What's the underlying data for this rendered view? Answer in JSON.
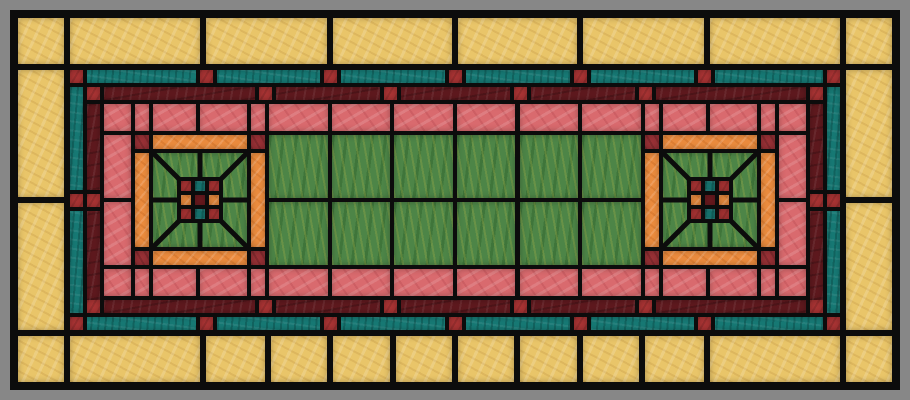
{
  "artwork": {
    "kind": "stained-glass-window-panel",
    "style": "prairie-arts-and-crafts",
    "medallion_count": 2
  },
  "palette": {
    "gray": "#878787",
    "lead": "#0c0c0c",
    "yellow": "#e9c569",
    "teal": "#177a75",
    "maroon": "#5f191e",
    "red": "#ab3434",
    "pink": "#d96a6e",
    "green": "#4d8547",
    "orange": "#ec8c3e",
    "dark_red": "#9a3136",
    "center_maroon": "#6d1a1f"
  },
  "design": {
    "canvas": [
      910,
      400
    ],
    "lead_field": [
      10,
      10,
      890,
      380
    ],
    "layers": [
      {
        "name": "yellow-border-pane",
        "color": "c-yellow",
        "rects": [
          [
            18,
            18,
            46,
            46
          ],
          [
            846,
            18,
            46,
            46
          ],
          [
            18,
            336,
            46,
            46
          ],
          [
            846,
            336,
            46,
            46
          ],
          [
            70,
            18,
            130,
            46
          ],
          [
            206,
            18,
            121,
            46
          ],
          [
            333,
            18,
            119,
            46
          ],
          [
            458,
            18,
            119,
            46
          ],
          [
            583,
            18,
            121,
            46
          ],
          [
            710,
            18,
            130,
            46
          ],
          [
            70,
            336,
            130,
            46
          ],
          [
            206,
            336,
            59,
            46
          ],
          [
            271,
            336,
            56,
            46
          ],
          [
            333,
            336,
            57,
            46
          ],
          [
            396,
            336,
            56,
            46
          ],
          [
            458,
            336,
            56,
            46
          ],
          [
            520,
            336,
            57,
            46
          ],
          [
            583,
            336,
            56,
            46
          ],
          [
            645,
            336,
            59,
            46
          ],
          [
            710,
            336,
            130,
            46
          ],
          [
            18,
            70,
            46,
            127
          ],
          [
            18,
            203,
            46,
            127
          ],
          [
            846,
            70,
            46,
            127
          ],
          [
            846,
            203,
            46,
            127
          ]
        ]
      },
      {
        "name": "teal-band-pane",
        "color": "c-teal",
        "rects": [
          [
            70,
            70,
            770,
            13
          ],
          [
            70,
            317,
            770,
            13
          ],
          [
            70,
            87,
            13,
            226
          ],
          [
            827,
            87,
            13,
            226
          ]
        ]
      },
      {
        "name": "maroon-band-pane",
        "color": "c-maroon",
        "rects": [
          [
            104,
            87,
            702,
            13
          ],
          [
            104,
            300,
            702,
            13
          ],
          [
            87,
            104,
            13,
            196
          ],
          [
            810,
            104,
            13,
            196
          ]
        ]
      },
      {
        "name": "maroon-band-corner-square",
        "color": "c-red",
        "rects": [
          [
            87,
            87,
            13,
            13
          ],
          [
            810,
            87,
            13,
            13
          ],
          [
            87,
            300,
            13,
            13
          ],
          [
            810,
            300,
            13,
            13
          ]
        ]
      },
      {
        "name": "pink-band-corner-pane",
        "color": "c-pink",
        "rects": [
          [
            104,
            104,
            27,
            27
          ],
          [
            779,
            104,
            27,
            27
          ],
          [
            104,
            269,
            27,
            27
          ],
          [
            779,
            269,
            27,
            27
          ]
        ]
      },
      {
        "name": "pink-band-pane",
        "color": "c-pink",
        "rects": [
          [
            135,
            104,
            14,
            27
          ],
          [
            153,
            104,
            43,
            27
          ],
          [
            200,
            104,
            47,
            27
          ],
          [
            251,
            104,
            14,
            27
          ],
          [
            269,
            104,
            59,
            27
          ],
          [
            332,
            104,
            58,
            27
          ],
          [
            394,
            104,
            59,
            27
          ],
          [
            457,
            104,
            58,
            27
          ],
          [
            520,
            104,
            58,
            27
          ],
          [
            582,
            104,
            59,
            27
          ],
          [
            645,
            104,
            14,
            27
          ],
          [
            663,
            104,
            43,
            27
          ],
          [
            710,
            104,
            47,
            27
          ],
          [
            761,
            104,
            14,
            27
          ],
          [
            135,
            269,
            14,
            27
          ],
          [
            153,
            269,
            43,
            27
          ],
          [
            200,
            269,
            47,
            27
          ],
          [
            251,
            269,
            14,
            27
          ],
          [
            269,
            269,
            59,
            27
          ],
          [
            332,
            269,
            58,
            27
          ],
          [
            394,
            269,
            59,
            27
          ],
          [
            457,
            269,
            58,
            27
          ],
          [
            520,
            269,
            58,
            27
          ],
          [
            582,
            269,
            59,
            27
          ],
          [
            645,
            269,
            14,
            27
          ],
          [
            663,
            269,
            43,
            27
          ],
          [
            710,
            269,
            47,
            27
          ],
          [
            761,
            269,
            14,
            27
          ],
          [
            104,
            135,
            27,
            63
          ],
          [
            104,
            202,
            27,
            63
          ],
          [
            779,
            135,
            27,
            63
          ],
          [
            779,
            202,
            27,
            63
          ]
        ]
      },
      {
        "name": "green-field-pane",
        "color": "c-green",
        "rects": [
          [
            269,
            135,
            59,
            63
          ],
          [
            332,
            135,
            58,
            63
          ],
          [
            394,
            135,
            59,
            63
          ],
          [
            457,
            135,
            58,
            63
          ],
          [
            520,
            135,
            58,
            63
          ],
          [
            582,
            135,
            59,
            63
          ],
          [
            269,
            202,
            59,
            63
          ],
          [
            332,
            202,
            58,
            63
          ],
          [
            394,
            202,
            59,
            63
          ],
          [
            457,
            202,
            58,
            63
          ],
          [
            520,
            202,
            58,
            63
          ],
          [
            582,
            202,
            59,
            63
          ]
        ]
      }
    ],
    "accent_squares": {
      "size": 13,
      "teal_band": [
        [
          70,
          70
        ],
        [
          200,
          70
        ],
        [
          324,
          70
        ],
        [
          449,
          70
        ],
        [
          574,
          70
        ],
        [
          698,
          70
        ],
        [
          827,
          70
        ],
        [
          70,
          317
        ],
        [
          200,
          317
        ],
        [
          324,
          317
        ],
        [
          449,
          317
        ],
        [
          574,
          317
        ],
        [
          698,
          317
        ],
        [
          827,
          317
        ],
        [
          70,
          194
        ],
        [
          827,
          194
        ]
      ],
      "maroon_band": [
        [
          259,
          87
        ],
        [
          384,
          87
        ],
        [
          514,
          87
        ],
        [
          639,
          87
        ],
        [
          259,
          300
        ],
        [
          384,
          300
        ],
        [
          514,
          300
        ],
        [
          639,
          300
        ],
        [
          87,
          194
        ],
        [
          810,
          194
        ]
      ]
    },
    "medallions": {
      "origins": [
        [
          135,
          135
        ],
        [
          645,
          135
        ]
      ],
      "size": 130,
      "corner_squares": [
        [
          0,
          0
        ],
        [
          116,
          0
        ],
        [
          0,
          116
        ],
        [
          116,
          116
        ]
      ],
      "corner_size": 14,
      "orange_bars": [
        [
          18,
          0,
          94,
          14
        ],
        [
          18,
          116,
          94,
          14
        ],
        [
          0,
          18,
          14,
          94
        ],
        [
          116,
          18,
          14,
          94
        ]
      ],
      "inner_square": [
        18,
        18,
        94,
        94
      ],
      "lead_lines": [
        [
          0,
          0,
          26,
          26
        ],
        [
          94,
          0,
          68,
          26
        ],
        [
          0,
          94,
          26,
          68
        ],
        [
          94,
          94,
          68,
          68
        ],
        [
          47,
          0,
          47,
          26
        ],
        [
          47,
          94,
          47,
          68
        ],
        [
          0,
          47,
          26,
          47
        ],
        [
          94,
          47,
          68,
          47
        ]
      ],
      "grid": {
        "rect": [
          42,
          42,
          46,
          46
        ],
        "cell": 10,
        "gap": 4,
        "colors": [
          [
            "red",
            "teal",
            "red"
          ],
          [
            "orange",
            "center_maroon",
            "orange"
          ],
          [
            "red",
            "teal",
            "red"
          ]
        ]
      }
    }
  }
}
